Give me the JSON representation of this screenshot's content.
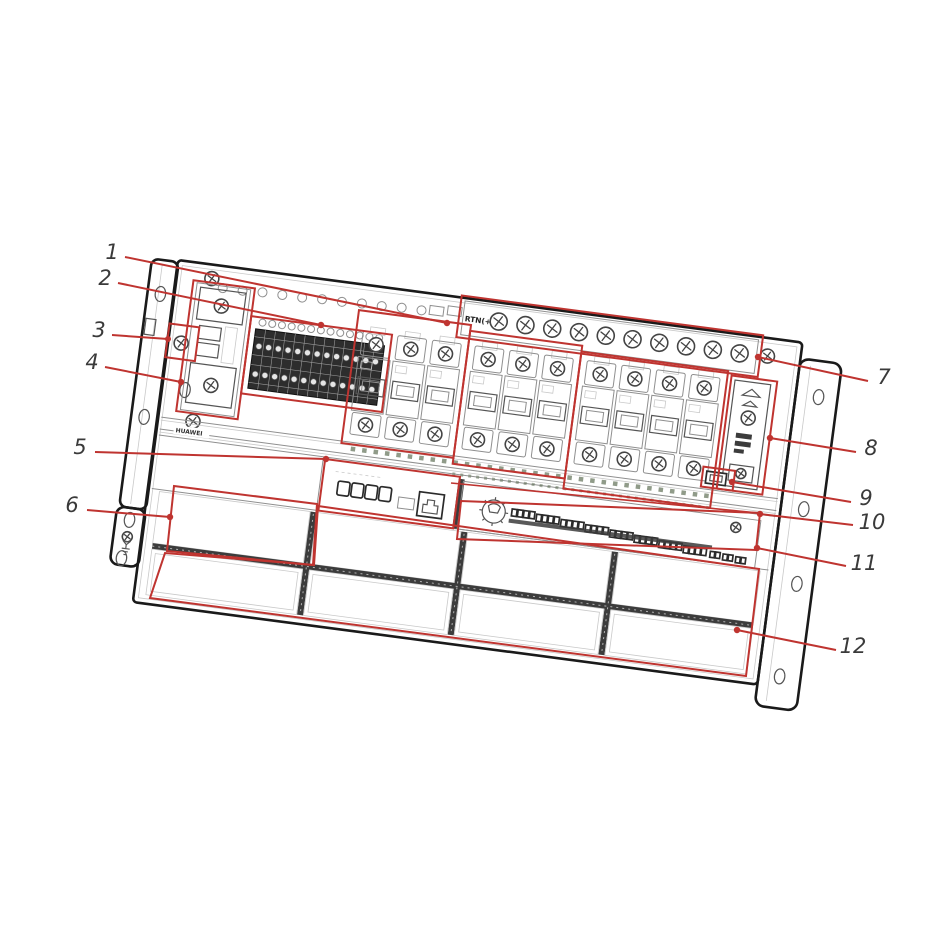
{
  "figure": {
    "kind": "hardware line drawing with numbered callouts",
    "callout_count": 12
  },
  "texts": {
    "rtn_label": "RTN(+)",
    "brand": "HUAWEI"
  },
  "callouts": [
    {
      "label": "1"
    },
    {
      "label": "2"
    },
    {
      "label": "3"
    },
    {
      "label": "4"
    },
    {
      "label": "5"
    },
    {
      "label": "6"
    },
    {
      "label": "7"
    },
    {
      "label": "8"
    },
    {
      "label": "9"
    },
    {
      "label": "10"
    },
    {
      "label": "11"
    },
    {
      "label": "12"
    }
  ],
  "drawing": {
    "breaker_count": 10,
    "rtn_screw_count": 10,
    "slot_rows": 2,
    "slot_cols": 4,
    "terminal_groups": 8
  },
  "colors": {
    "annotation": "#bf3430",
    "outline": "#1a1a1a",
    "line": "#8f8f8f",
    "line_dark": "#555555",
    "fill_dark": "#3c3c3c",
    "tick": "#6b7a62",
    "label_text": "#3a3a3a",
    "bg": "#ffffff"
  }
}
